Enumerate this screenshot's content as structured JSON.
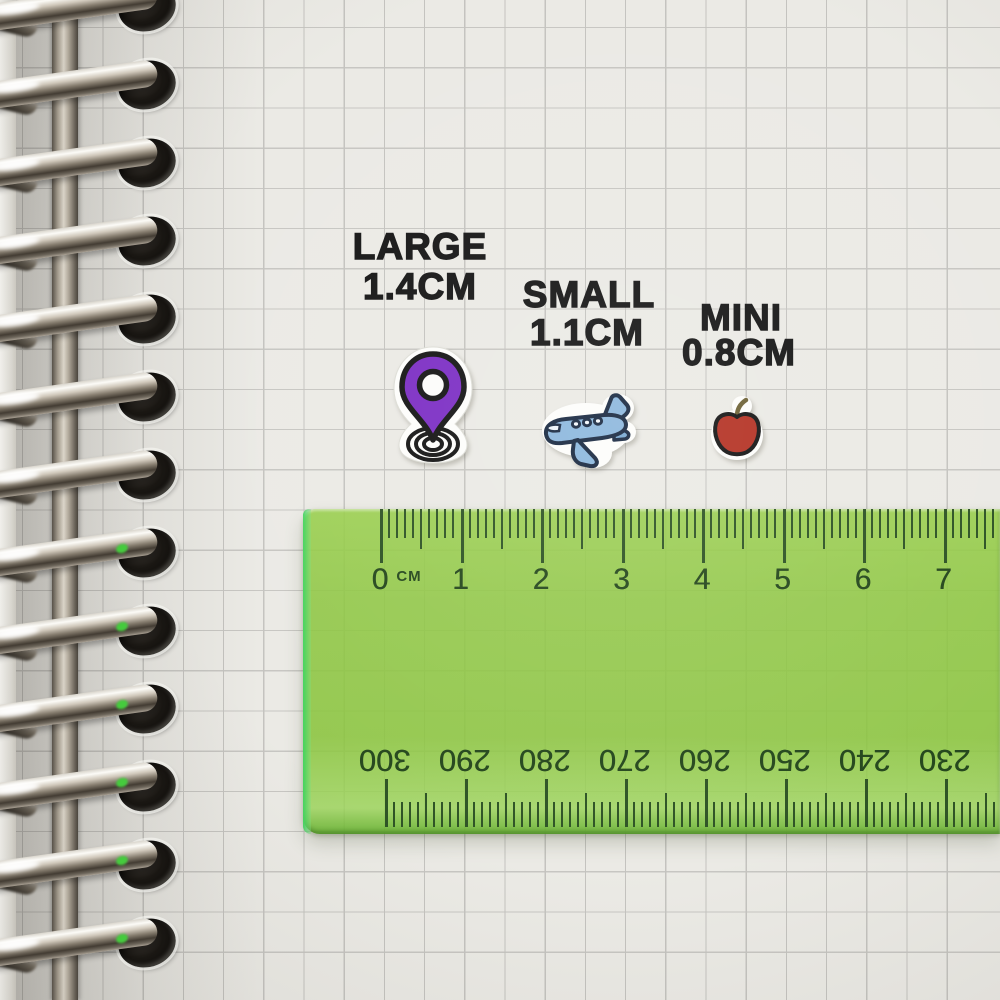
{
  "size_labels": [
    {
      "label": "LARGE",
      "size": "1.4CM"
    },
    {
      "label": "SMALL",
      "size": "1.1CM"
    },
    {
      "label": "MINI",
      "size": "0.8CM"
    }
  ],
  "stickers": [
    {
      "name": "location-pin",
      "color": "#7c2ec4"
    },
    {
      "name": "airplane",
      "color": "#8cb7dd"
    },
    {
      "name": "apple",
      "color": "#b43224"
    }
  ],
  "ruler": {
    "unit_label": "CM",
    "top_scale_numbers": [
      "0",
      "1",
      "2",
      "3",
      "4",
      "5",
      "6",
      "7"
    ],
    "bottom_scale_numbers": [
      "300",
      "290",
      "280",
      "270",
      "260",
      "250",
      "240",
      "230"
    ],
    "body_color": "#8bc43e",
    "marking_color": "#2b4e21"
  },
  "notebook": {
    "ring_count": 13,
    "paper_color": "#ebeae5",
    "grid_color": "#c5c4c0"
  }
}
